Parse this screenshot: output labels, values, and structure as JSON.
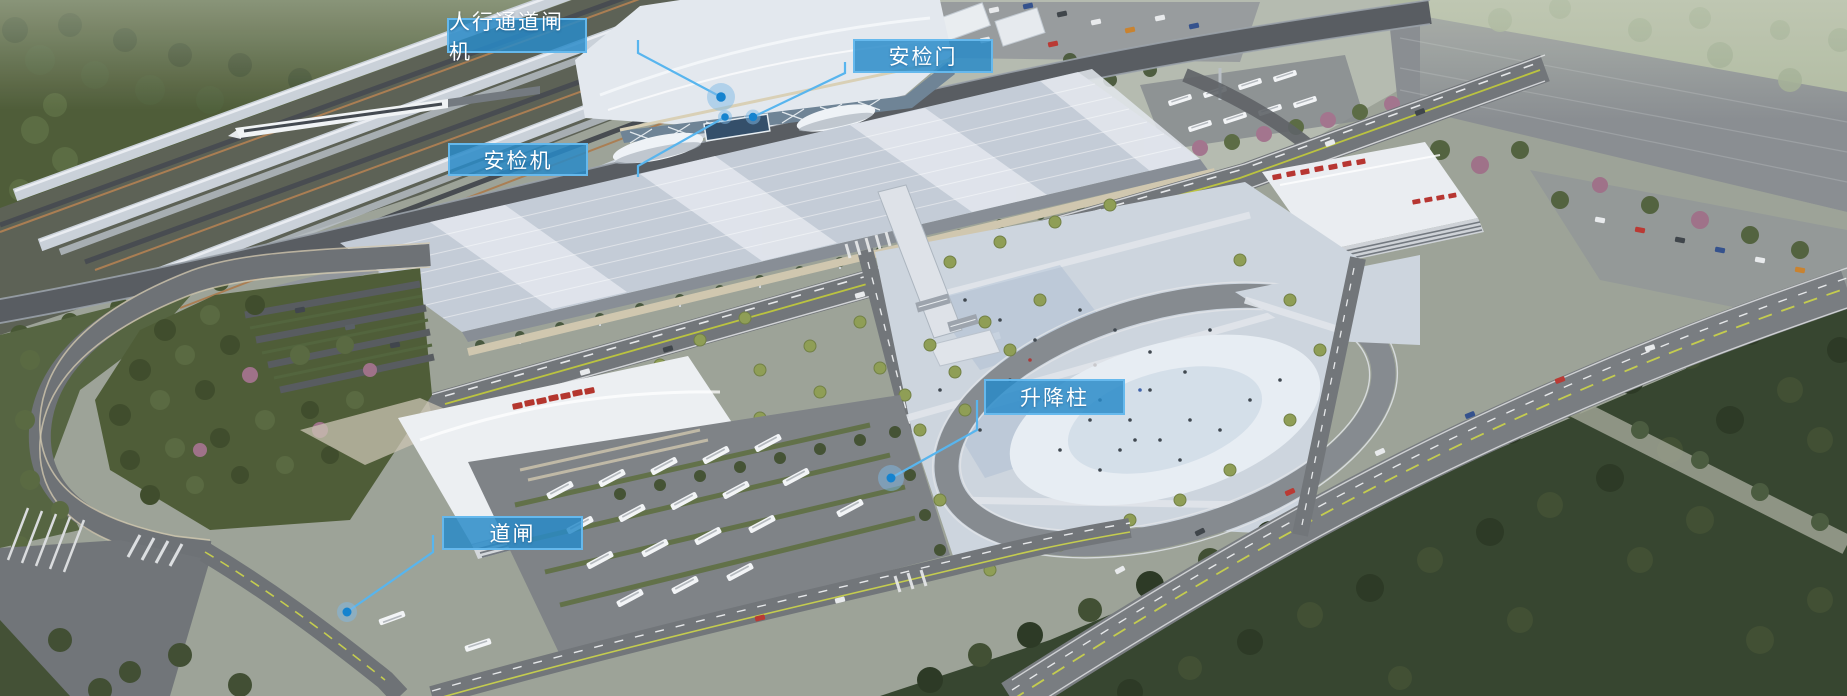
{
  "annotations": {
    "items": [
      {
        "id": "pedestrian-gate",
        "label": "人行通道闸机"
      },
      {
        "id": "security-door",
        "label": "安检门"
      },
      {
        "id": "security-scanner",
        "label": "安检机"
      },
      {
        "id": "lift-bollard",
        "label": "升降柱"
      },
      {
        "id": "barrier-gate",
        "label": "道闸"
      }
    ]
  },
  "colors": {
    "callout_background": "#2a8ac8",
    "callout_border": "#68bbee",
    "callout_text": "#ffffff",
    "leader_line": "#58b5ee",
    "marker_dot": "#1583cf",
    "marker_halo": "#7fb9e6"
  }
}
